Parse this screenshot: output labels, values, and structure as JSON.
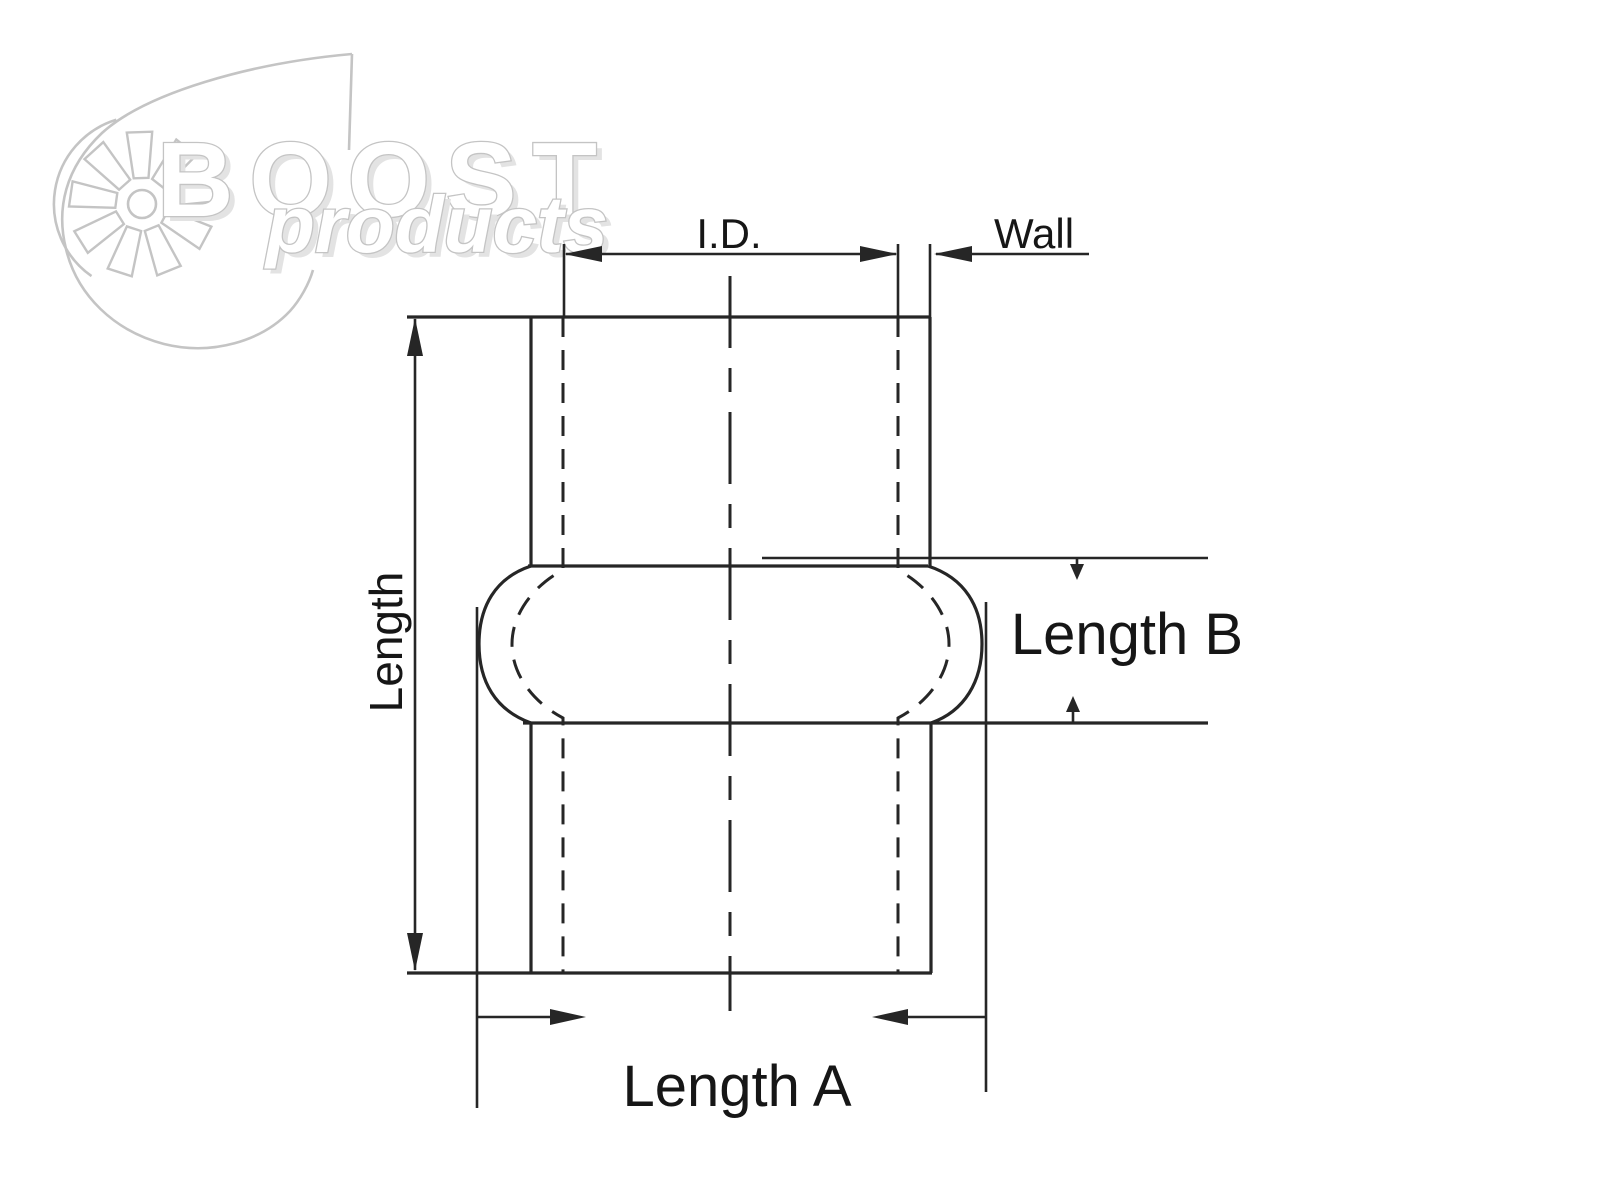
{
  "diagram": {
    "type": "technical-dimension-drawing",
    "subject": "hump hose coupler front view",
    "labels": {
      "inner_diameter": "I.D.",
      "wall": "Wall",
      "length": "Length",
      "length_a": "Length A",
      "length_b": "Length B"
    },
    "colors": {
      "line": "#262626",
      "label": "#161616",
      "background": "#ffffff"
    }
  },
  "logo": {
    "brand": "BOOST",
    "sub_brand": "products",
    "colors": {
      "stroke": "#c4c4c4",
      "shadow": "#e3e3e3",
      "fill": "#ffffff"
    }
  }
}
